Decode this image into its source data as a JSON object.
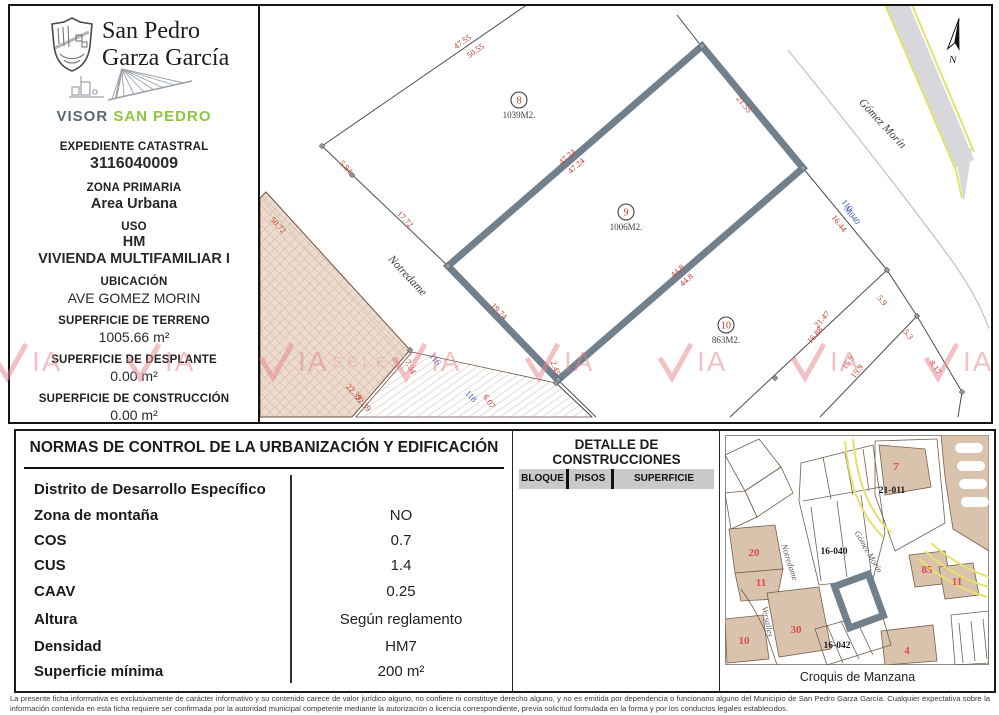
{
  "colors": {
    "dimred": "#c0392b",
    "lotblue": "#4153c4",
    "parcelgray": "#72808c",
    "tan": "#ecdccd",
    "hatch": "#cf9f8e",
    "croquistan": "#d9c3ad",
    "yellow": "#e2e26d",
    "visorgreen": "#8cc63e",
    "visorgray": "#5b6770",
    "watermark": "#e4848f",
    "headergray": "#c9c9c9"
  },
  "sidebar": {
    "muni1": "San Pedro",
    "muni2": "Garza García",
    "visor_bold": "VISOR",
    "visor_light": "SAN PEDRO",
    "expediente_label": "EXPEDIENTE CATASTRAL",
    "expediente": "3116040009",
    "zona_label": "ZONA PRIMARIA",
    "zona": "Area Urbana",
    "uso_label": "USO",
    "uso1": "HM",
    "uso2": "VIVIENDA MULTIFAMILIAR I",
    "ubicacion_label": "UBICACIÓN",
    "ubicacion": "AVE GOMEZ MORIN",
    "terreno_label": "SUPERFICIE DE TERRENO",
    "terreno": "1005.66 m²",
    "desplante_label": "SUPERFICIE DE DESPLANTE",
    "desplante": "0.00 m²",
    "construccion_label": "SUPERFICIE DE CONSTRUCCIÓN",
    "construccion": "0.00 m²"
  },
  "map": {
    "north": "N",
    "streets": [
      "Notredame",
      "Gómez Morín"
    ],
    "parcels": [
      {
        "num": "8",
        "area": "1039M2."
      },
      {
        "num": "9",
        "area": "1006M2."
      },
      {
        "num": "10",
        "area": "863M2."
      }
    ],
    "dims": [
      "47.55",
      "50.55",
      "5.94",
      "17.72",
      "47.24",
      "47.24",
      "21.55",
      "44.8",
      "44.8",
      "19.74",
      "2.45",
      "50.72",
      "22.39",
      "22.39",
      "7.34",
      "6.07",
      "116",
      "118",
      "110",
      "M040",
      "16.44",
      "21.47",
      "16.88",
      "5.9",
      "5.3",
      "15.9",
      "15.9",
      "8.17"
    ]
  },
  "normas": {
    "title": "NORMAS DE CONTROL DE LA URBANIZACIÓN Y EDIFICACIÓN",
    "rows": [
      {
        "label": "Distrito de Desarrollo Específico",
        "value": ""
      },
      {
        "label": "Zona de montaña",
        "value": "NO"
      },
      {
        "label": "COS",
        "value": "0.7"
      },
      {
        "label": "CUS",
        "value": "1.4"
      },
      {
        "label": "CAAV",
        "value": "0.25"
      },
      {
        "label": "Altura",
        "value": "Según reglamento"
      },
      {
        "label": "Densidad",
        "value": "HM7"
      },
      {
        "label": "Superficie mínima",
        "value": "200 m²"
      }
    ]
  },
  "detalle": {
    "title1": "DETALLE DE",
    "title2": "CONSTRUCCIONES",
    "columns": [
      "BLOQUE",
      "PISOS",
      "SUPERFICIE"
    ]
  },
  "croquis": {
    "caption": "Croquis de Manzana",
    "blocks": [
      "21-011",
      "16-040",
      "16-042"
    ],
    "reds": [
      "7",
      "20",
      "85",
      "11",
      "11",
      "30",
      "10",
      "4"
    ],
    "streets": [
      "Notredame",
      "Gómez Morín",
      "Versalles"
    ]
  },
  "watermark": {
    "ia": "IA",
    "trail": "EBLES"
  },
  "footer": {
    "text": "La presente ficha informativa es exclusivamente de carácter informativo y su contenido carece de valor jurídico alguno, no confiere ni constituye derecho alguno, y no es emitida por dependencia o funcionario alguno del Municipio de San Pedro Garza García. Cualquier expectativa sobre la información contenida en esta ficha requiere ser confirmada por la autoridad municipal competente mediante la autorización o licencia correspondiente, previa solicitud formulada en la forma y por los conductos legales establecidos."
  }
}
